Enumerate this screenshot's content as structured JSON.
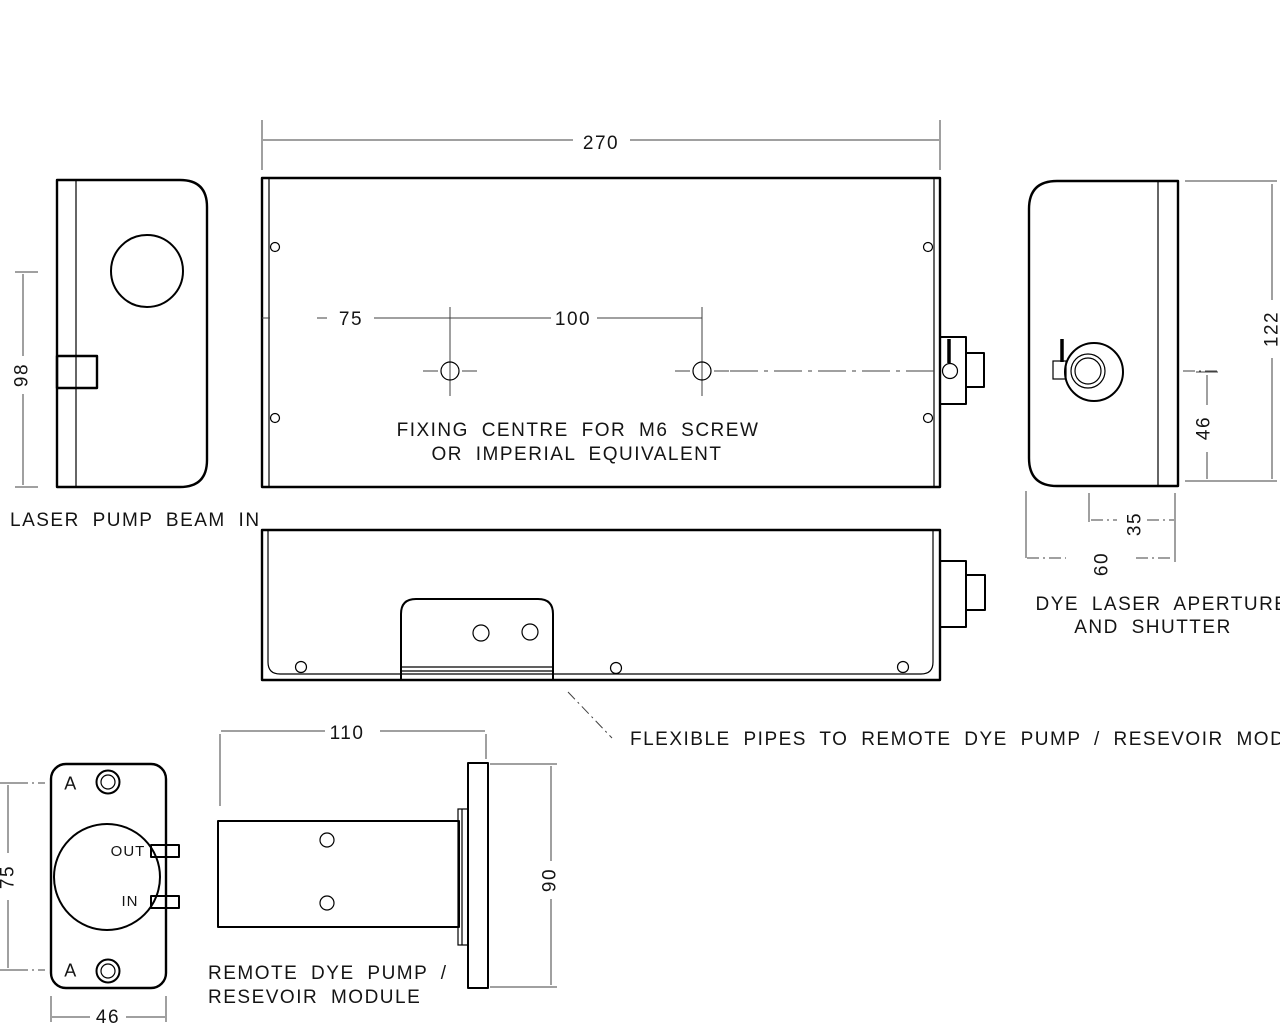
{
  "colors": {
    "background": "#ffffff",
    "outline": "#000000",
    "dimension_lines": "#404040",
    "text": "#141414"
  },
  "views": {
    "pump_beam_side": {
      "caption": "LASER PUMP BEAM IN",
      "dims": {
        "height": "98"
      }
    },
    "plan": {
      "dims": {
        "width": "270",
        "fixing_offset": "75",
        "fixing_spacing": "100"
      },
      "note_line1": "FIXING CENTRE FOR M6 SCREW",
      "note_line2": "OR IMPERIAL EQUIVALENT"
    },
    "aperture_end": {
      "caption_line1": "DYE LASER APERTURE",
      "caption_line2": "AND SHUTTER",
      "dims": {
        "height": "122",
        "aperture_centre": "46",
        "aperture_offset": "35",
        "depth": "60"
      }
    },
    "side": {
      "leader_note": "FLEXIBLE PIPES TO REMOTE DYE PUMP / RESEVOIR MODULE"
    },
    "pump_front": {
      "hole_label_top": "A",
      "hole_label_bottom": "A",
      "port_out": "OUT",
      "port_in": "IN",
      "dims": {
        "height": "75",
        "width": "46"
      }
    },
    "pump_side": {
      "caption_line1": "REMOTE DYE PUMP /",
      "caption_line2": "RESEVOIR MODULE",
      "dims": {
        "length": "110",
        "height": "90"
      }
    }
  }
}
